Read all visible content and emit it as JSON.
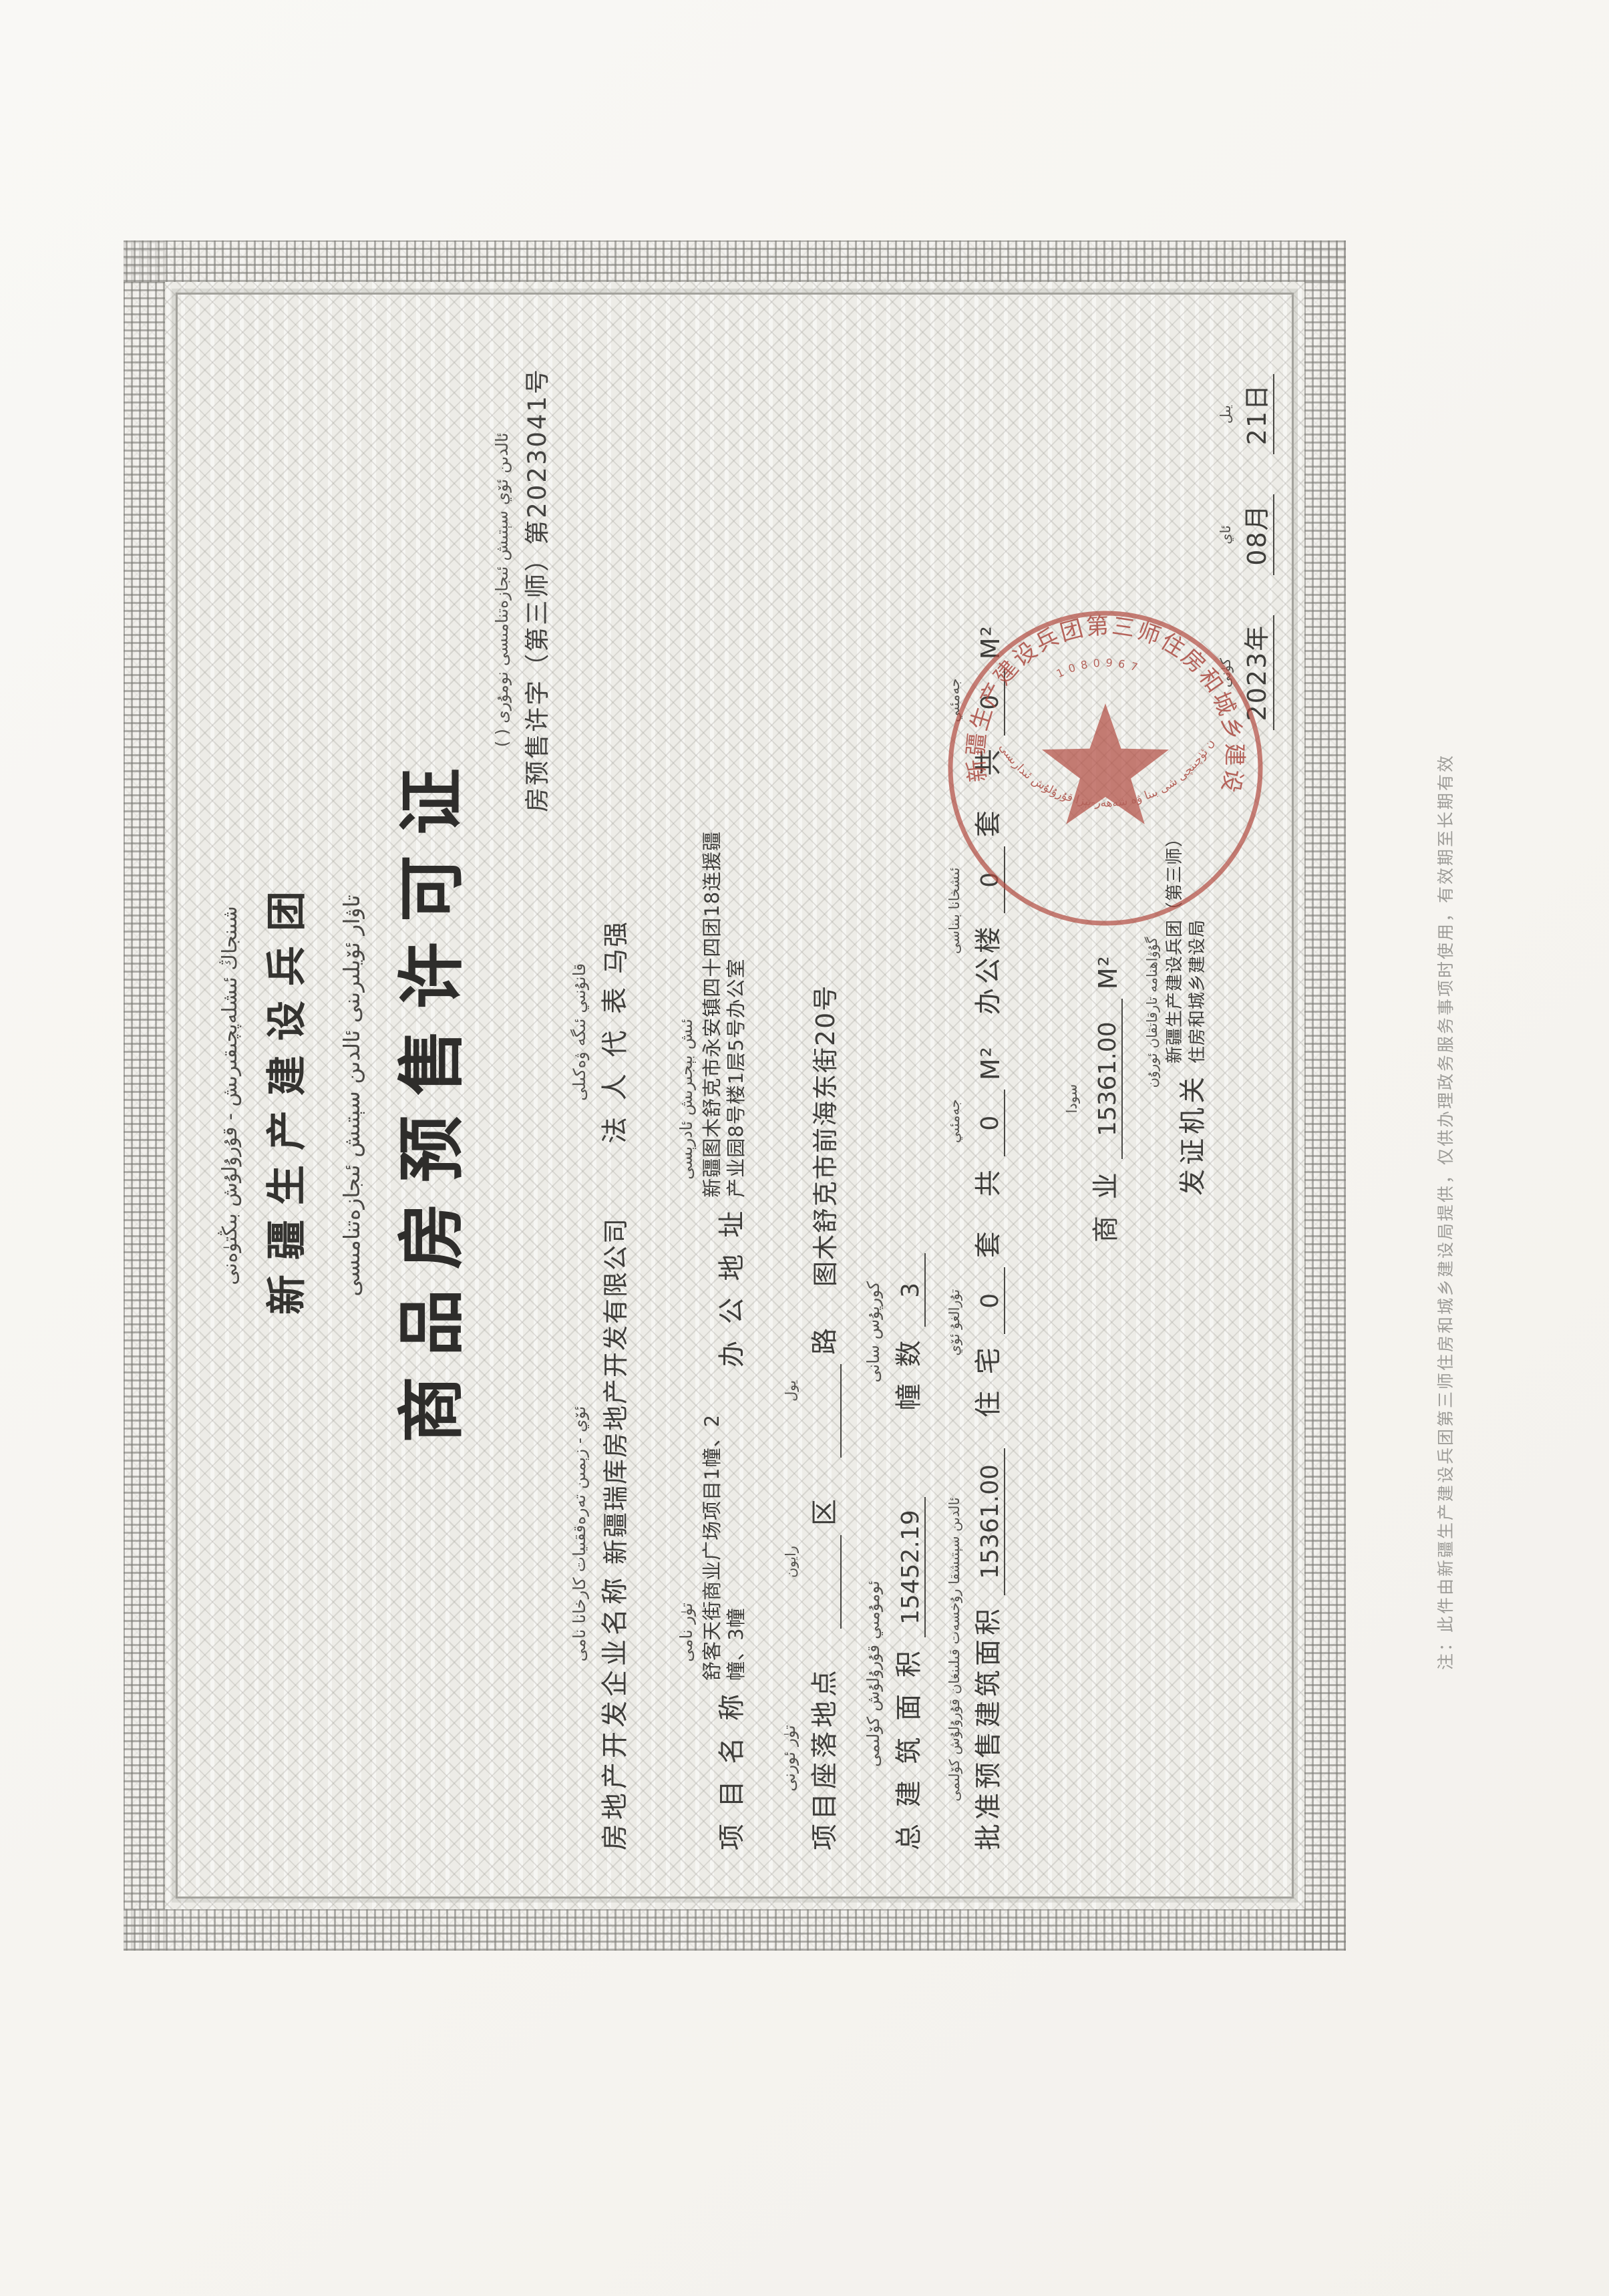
{
  "page": {
    "kind": "scanned certificate"
  },
  "certificate": {
    "header_uyghur": "شىنجاڭ ئىشلەپچىقىرىش - قۇرۇلۇش بىڭتۈەنى",
    "header_cn": "新疆生产建设兵团",
    "title_uyghur": "تاۋار ئۆيلىرىنى ئالدىن سېتىش ئىجازەتنامىسى",
    "title_cn": "商品房预售许可证",
    "permit_no_uyghur": "ئالدىن ئۆي سېتىش ئىجازەتنامىسى نومۇرى (  )",
    "permit_no_cn": "房预售许字（第三师）第2023041号",
    "fields": {
      "developer": {
        "uy": "ئۆي - زېمىن تەرەققىيات كارخانا نامى",
        "label": "房地产开发企业名称",
        "value": "新疆瑞库房地产开发有限公司"
      },
      "legal_rep": {
        "uy": "قانۇنىي ئىگە ۋەكىلى",
        "label": "法 人 代 表",
        "value": "马强"
      },
      "project_name": {
        "uy": "تۈر نامى",
        "label": "项 目 名 称",
        "value_line1": "舒客天街商业广场项目1幢、2",
        "value_line2": "幢、3幢"
      },
      "office_address": {
        "uy": "ئىش بېجىرىش ئادرېسى",
        "label": "办 公 地 址",
        "value_line1": "新疆图木舒克市永安镇四十四团18连援疆",
        "value_line2": "产业园8号楼1层5号办公室"
      },
      "location": {
        "uy": "تۈر ئورنى",
        "label": "项目座落地点",
        "district_uy": "رايون",
        "district_cn": "区",
        "road_uy": "يول",
        "road_cn": "路",
        "blank": "",
        "value": "图木舒克市前海东街20号"
      },
      "total_area": {
        "uy": "ئومۇمىي قۇرۇلۇش كۆلىمى",
        "label": "总 建 筑 面 积",
        "value": "15452.19"
      },
      "building_count": {
        "uy": "كورپۇس سانى",
        "label": "幢  数",
        "value": "3"
      },
      "approved_area": {
        "uy": "ئالدىن سېتىشقا رۇخسەت قىلىنغان قۇرۇلۇش كۆلىمى",
        "label": "批准预售建筑面积",
        "value": "15361.00"
      },
      "residential": {
        "uy": "تۇرالغۇ ئۆي",
        "label": "住 宅",
        "units": "0",
        "tao": "套",
        "gong": "共",
        "gong_uy": "جەمئىي",
        "area": "0",
        "unit": "M²"
      },
      "office_building": {
        "uy": "ئىشخانا بىناسى",
        "label": "办公楼",
        "units": "0",
        "tao": "套",
        "gong": "共",
        "gong_uy": "جەمئىي",
        "area": "0",
        "unit": "M²"
      },
      "commercial": {
        "uy": "سودا",
        "label": "商  业",
        "value": "15361.00",
        "unit": "M²"
      }
    },
    "issuer": {
      "uy": "گۇۋاھنامە تارقاتقان ئورۇن",
      "label": "发证机关",
      "value_line1": "新疆生产建设兵团（第三师）",
      "value_line2": "住房和城乡建设局"
    },
    "date": {
      "uy_year_side": "كۈنى",
      "uy_month_side": "ئاي",
      "uy_day_side": "يىل",
      "year": "2023年",
      "month": "08月",
      "day": "21日"
    },
    "seal": {
      "color": "#b04a40",
      "arc_text_cn": "新疆生产建设兵团第三师住房和城乡建设局",
      "arc_text_uy": "بىڭتۈەن ئۈچىنچى شى بىنا ۋە شەھەر-يېزا قۇرۇلۇش ئىدارىسى",
      "serial": "1080967"
    },
    "side_note": "注：此件由新疆生产建设兵团第三师住房和城乡建设局提供，仅供办理政务服务事项时使用，有效期至长期有效"
  }
}
